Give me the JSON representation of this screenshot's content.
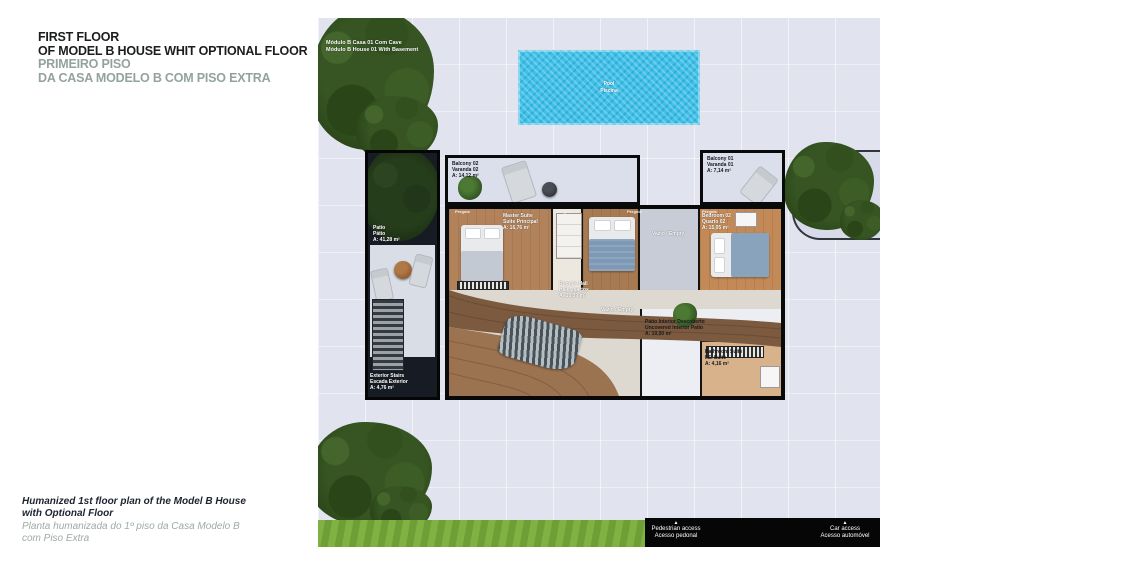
{
  "colors": {
    "title_accent": "#93a39c",
    "pool_blue": "#3fc0e7",
    "grass_green": "#7ab03e",
    "paving": "#e1e4ef",
    "wood": "#8a6a4e",
    "tree_green": "#365522"
  },
  "header": {
    "en_line1": "FIRST FLOOR",
    "en_line2": "OF MODEL B HOUSE WHIT OPTIONAL FLOOR",
    "pt_line1": "PRIMEIRO PISO",
    "pt_line2": "DA CASA MODELO B COM PISO  EXTRA"
  },
  "caption": {
    "en_line1": "Humanized 1st floor plan of the Model B House",
    "en_line2": "with Optional Floor",
    "pt_line1": "Planta humanizada do 1º piso da Casa Modelo B",
    "pt_line2": "com Piso Extra"
  },
  "plan": {
    "module_label": {
      "line1": "Módulo B Casa 01 Com Cave",
      "line2": "Módulo B House 01 With Basement"
    },
    "pool": {
      "line1": "Pool",
      "line2": "Piscina"
    },
    "labels": {
      "balcony02": {
        "line1": "Balcony 02",
        "line2": "Varanda 02",
        "line3": "A: 14,12 m²"
      },
      "balcony01": {
        "line1": "Balcony 01",
        "line2": "Varanda 01",
        "line3": "A: 7,14 m²"
      },
      "patio": {
        "line1": "Patio",
        "line2": "Pátio",
        "line3": "A: 41,28 m²"
      },
      "master_suite": {
        "line1": "Master Suite",
        "line2": "Suite Principal",
        "line3": "A: 16,76 m²"
      },
      "bedroom02": {
        "line1": "Bedroom 02",
        "line2": "Quarto 02",
        "line3": "A: 15,05 m²"
      },
      "rooms_hall": {
        "line1": "Room's Hall",
        "line2": "Hall Quartos",
        "line3": "A: 10,39 m²"
      },
      "empty_a": {
        "line1": "Vazio / Empty"
      },
      "empty_b": {
        "line1": "Vazio / Empty"
      },
      "interior_patio": {
        "line1": "Pátio Interior Descoberto",
        "line2": "Uncovered Interior Patio",
        "line3": "A: 10,50 m²"
      },
      "bathroom_suite": {
        "line1": "Bathroom Suite",
        "line2": "I.S. Suite",
        "line3": "A: 4,16 m²"
      },
      "exterior_stairs": {
        "line1": "Exterior Stairs",
        "line2": "Escada Exterior",
        "line3": "A: 4,76 m²"
      },
      "pergola_1": "Pérgola",
      "pergola_2": "Pérgola",
      "pergola_3": "Pérgola",
      "pergola_4": "Pérgola"
    },
    "access": {
      "pedestrian": {
        "marker": "▲",
        "line1": "Pedestrian access",
        "line2": "Acesso pedonal"
      },
      "car": {
        "marker": "▲",
        "line1": "Car access",
        "line2": "Acesso automóvel"
      }
    }
  }
}
